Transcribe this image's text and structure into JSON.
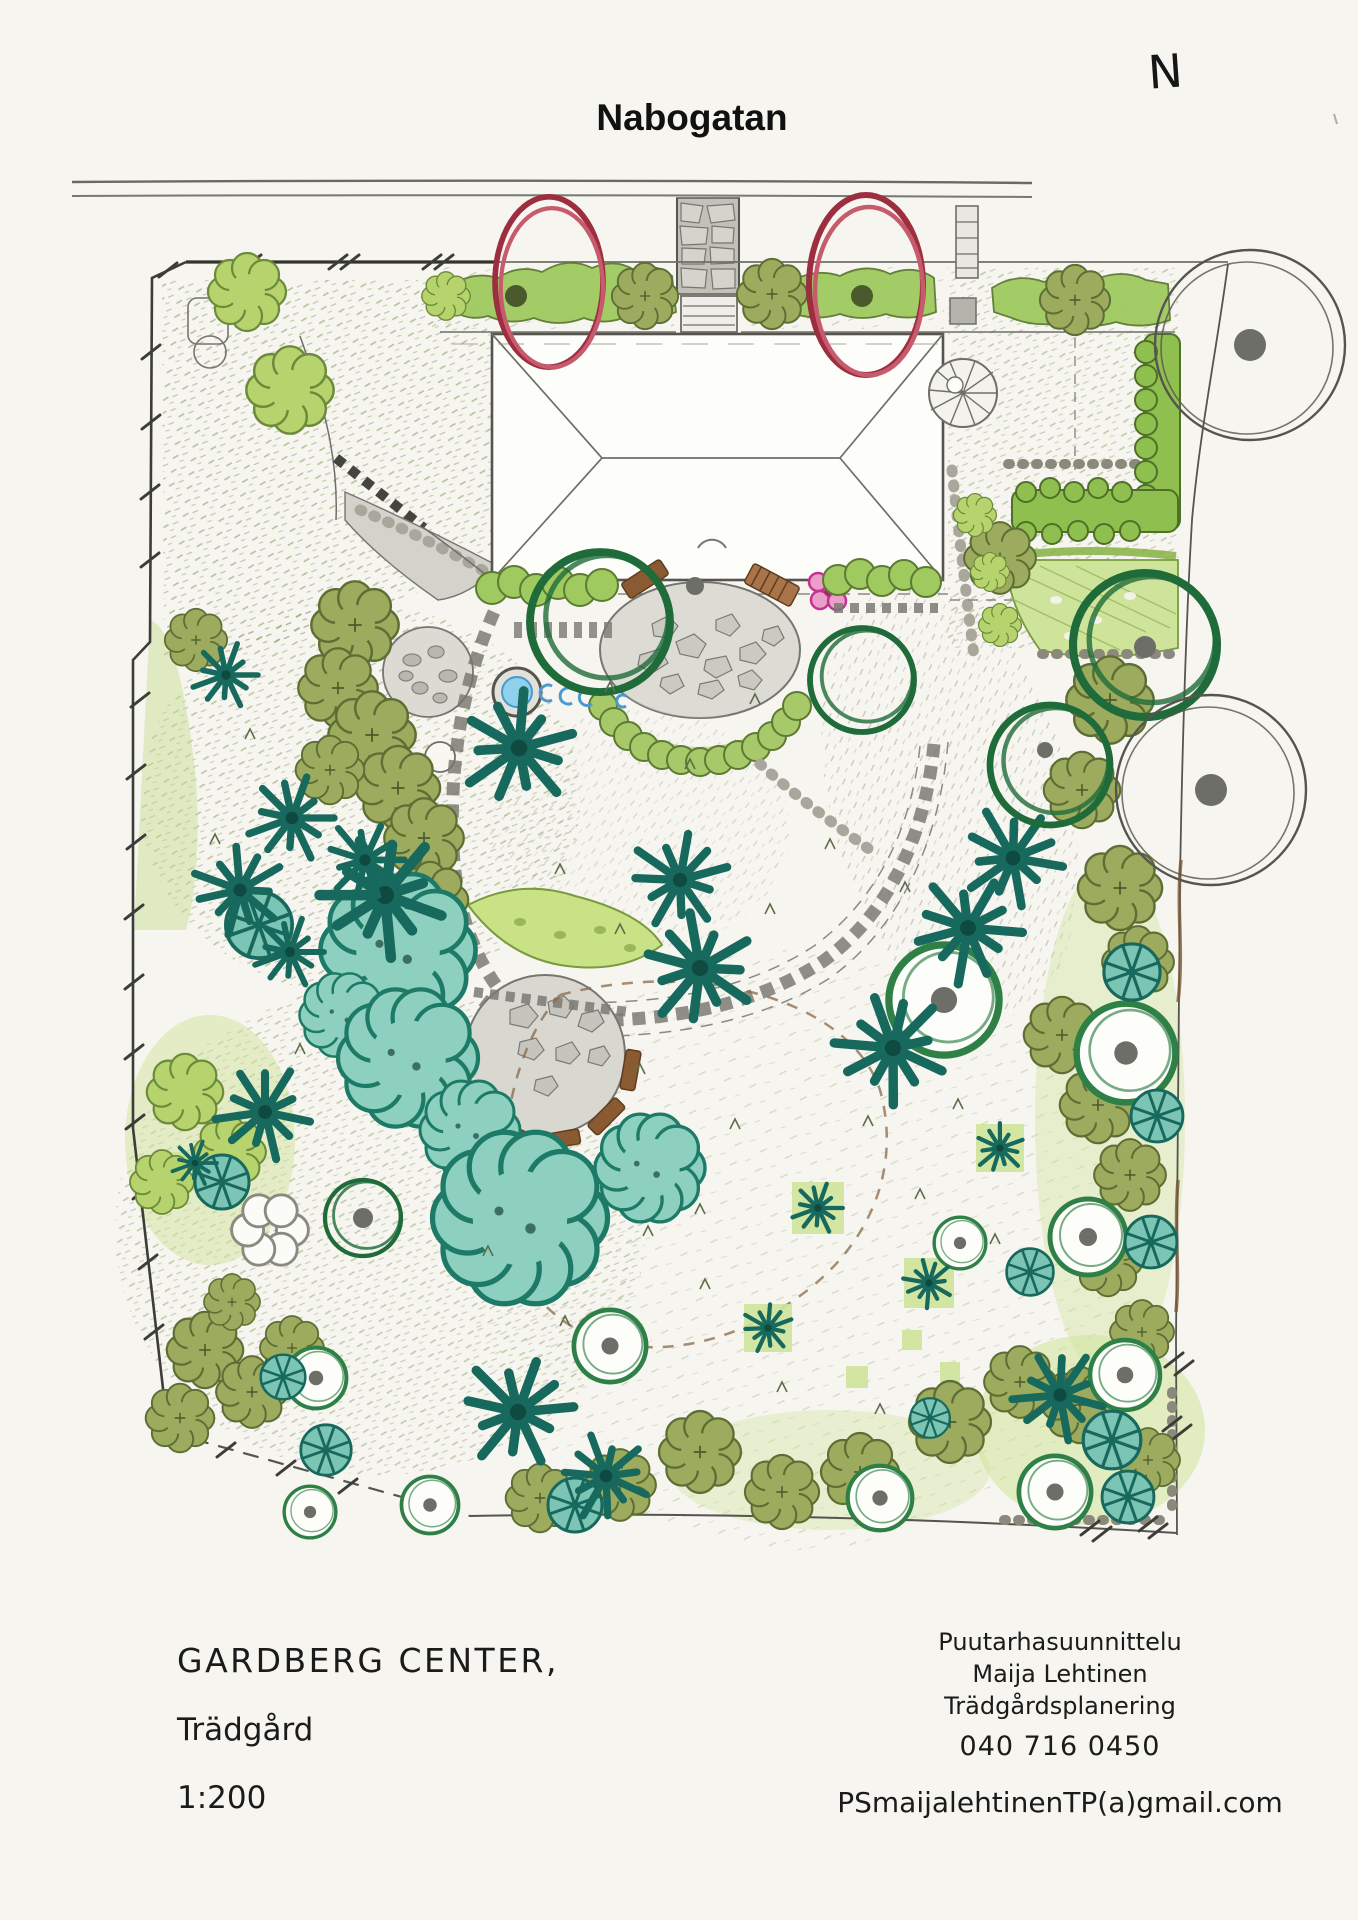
{
  "street": {
    "name": "Nabogatan"
  },
  "compass": {
    "label": "N"
  },
  "title_block": {
    "project": "GARDBERG CENTER,",
    "site": "Trädgård",
    "scale": "1:200"
  },
  "designer_block": {
    "line1": "Puutarhasuunnittelu",
    "line2": "Maija Lehtinen",
    "line3": "Trädgårdsplanering",
    "phone": "040 716 0450",
    "email": "PSmaijalehtinenTP(a)gmail.com"
  },
  "plan": {
    "type": "hand-drawn garden landscape plan",
    "features": [
      "house-footprint",
      "stone-driveway",
      "front-hedge",
      "red-marked-trees",
      "spiral-stair",
      "vegetable-garden",
      "circular-stone-patio",
      "pond",
      "stepping-stone-paths",
      "semicircular-bench-patio",
      "teal-canopy-trees",
      "conifer-star-trees",
      "olive-shrub-trees",
      "ring-trees",
      "pinwheel-trees",
      "large-pencil-circle-trees",
      "lawn",
      "dashed-play-loop",
      "site-boundary"
    ]
  },
  "colors": {
    "paper": "#f6f5ef",
    "pencil": "#55544e",
    "red_ring": "#9c2e40",
    "teal_outline": "#1d7a66",
    "teal_fill": "#8ed0c0",
    "olive": "#9cab5e",
    "light_green": "#b7d36e",
    "hedge_green": "#9fca5f",
    "dark_green_ring": "#1f6b3a",
    "stone_gray": "#b9b8b0",
    "bench_brown": "#8a5a32",
    "pond_blue": "#8fd0ea",
    "flower_pink": "#ec9ecb"
  }
}
